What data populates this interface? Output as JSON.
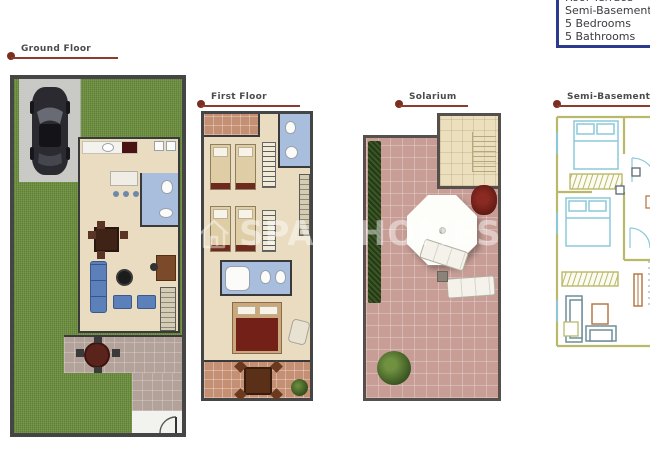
{
  "info_box": {
    "lines": [
      "Roof Terrace",
      "Semi-Basement",
      "5 Bedrooms",
      "5 Bathrooms"
    ],
    "border_color": "#2c3a8e",
    "text_color": "#3b3b40"
  },
  "floor_plans": [
    {
      "label": "Ground Floor"
    },
    {
      "label": "First Floor"
    },
    {
      "label": "Solarium"
    },
    {
      "label": "Semi-Basement"
    }
  ],
  "watermark": {
    "text": "SPAINHOMES",
    "mark": "®"
  },
  "colors": {
    "label_text": "#4b4b4b",
    "label_line": "#8d3b2b",
    "label_dot": "#7c2e20",
    "wall": "#454545",
    "grass": "#6e9040",
    "hedge": "#3a5724",
    "driveway": "#c9c9c5",
    "interior_floor": "#e9dcc0",
    "bathroom_floor": "#a8bedc",
    "terrace_ground": "#b3a29a",
    "terrace_first": "#c48f73",
    "solarium_tile": "#c79d95",
    "stair_area": "#ecdfbe",
    "sofa_blue": "#5b80ba",
    "wood_dark": "#4a2c1e",
    "bed_red": "#722018",
    "cad_wall": "#b9b96a",
    "cad_fixture": "#8cc8d8",
    "cad_accent": "#b0703c",
    "watermark": "rgba(255,255,255,0.45)"
  }
}
